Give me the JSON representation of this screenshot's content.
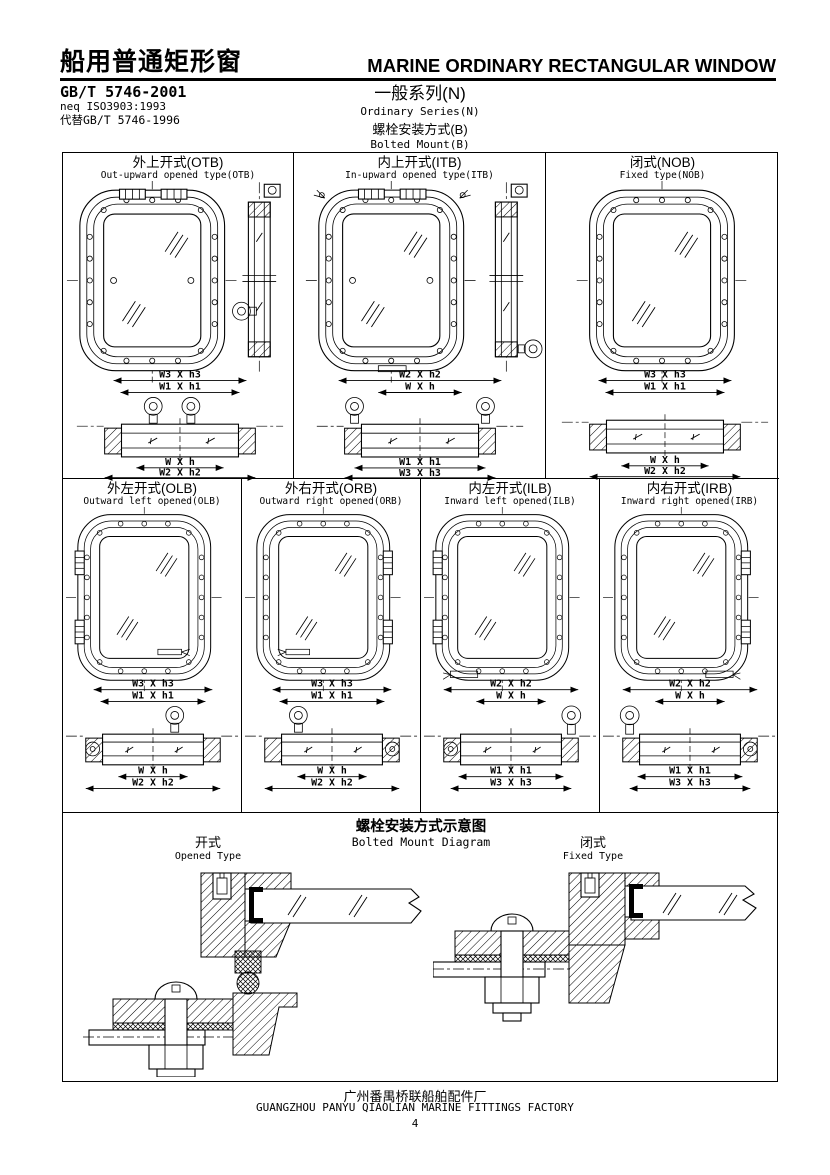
{
  "header": {
    "title_cn": "船用普通矩形窗",
    "title_en": "MARINE ORDINARY RECTANGULAR WINDOW",
    "standards": [
      "GB/T 5746-2001",
      "neq ISO3903:1993",
      "代替GB/T 5746-1996"
    ],
    "series_cn": "一般系列(N)",
    "series_en": "Ordinary Series(N)",
    "mount_cn": "螺栓安装方式(B)",
    "mount_en": "Bolted Mount(B)"
  },
  "cells": {
    "otb": {
      "title_cn": "外上开式(OTB)",
      "title_en": "Out-upward opened type(OTB)",
      "dims": {
        "top1": "W3 X h3",
        "top2": "W1 X h1",
        "bot1": "W X h",
        "bot2": "W2 X h2"
      }
    },
    "itb": {
      "title_cn": "内上开式(ITB)",
      "title_en": "In-upward opened type(ITB)",
      "dims": {
        "top1": "W2 X h2",
        "top2": "W X h",
        "bot1": "W1 X h1",
        "bot2": "W3 X h3"
      }
    },
    "nob": {
      "title_cn": "闭式(NOB)",
      "title_en": "Fixed type(NOB)",
      "dims": {
        "top1": "W3 X h3",
        "top2": "W1 X h1",
        "bot1": "W X h",
        "bot2": "W2 X h2"
      }
    },
    "olb": {
      "title_cn": "外左开式(OLB)",
      "title_en": "Outward left opened(OLB)",
      "dims": {
        "top1": "W3 X h3",
        "top2": "W1 X h1",
        "bot1": "W X h",
        "bot2": "W2 X h2"
      }
    },
    "orb": {
      "title_cn": "外右开式(ORB)",
      "title_en": "Outward right opened(ORB)",
      "dims": {
        "top1": "W3 X h3",
        "top2": "W1 X h1",
        "bot1": "W X h",
        "bot2": "W2 X h2"
      }
    },
    "ilb": {
      "title_cn": "内左开式(ILB)",
      "title_en": "Inward left opened(ILB)",
      "dims": {
        "top1": "W2 X h2",
        "top2": "W X h",
        "bot1": "W1 X h1",
        "bot2": "W3 X h3"
      }
    },
    "irb": {
      "title_cn": "内右开式(IRB)",
      "title_en": "Inward right opened(IRB)",
      "dims": {
        "top1": "W2 X h2",
        "top2": "W X h",
        "bot1": "W1 X h1",
        "bot2": "W3 X h3"
      }
    }
  },
  "diagram": {
    "title_cn": "螺栓安装方式示意图",
    "title_en": "Bolted Mount Diagram",
    "opened_cn": "开式",
    "opened_en": "Opened Type",
    "fixed_cn": "闭式",
    "fixed_en": "Fixed Type"
  },
  "footer": {
    "factory_cn": "广州番禺桥联船舶配件厂",
    "factory_en": "GUANGZHOU PANYU QIAOLIAN MARINE FITTINGS FACTORY",
    "page": "4"
  }
}
